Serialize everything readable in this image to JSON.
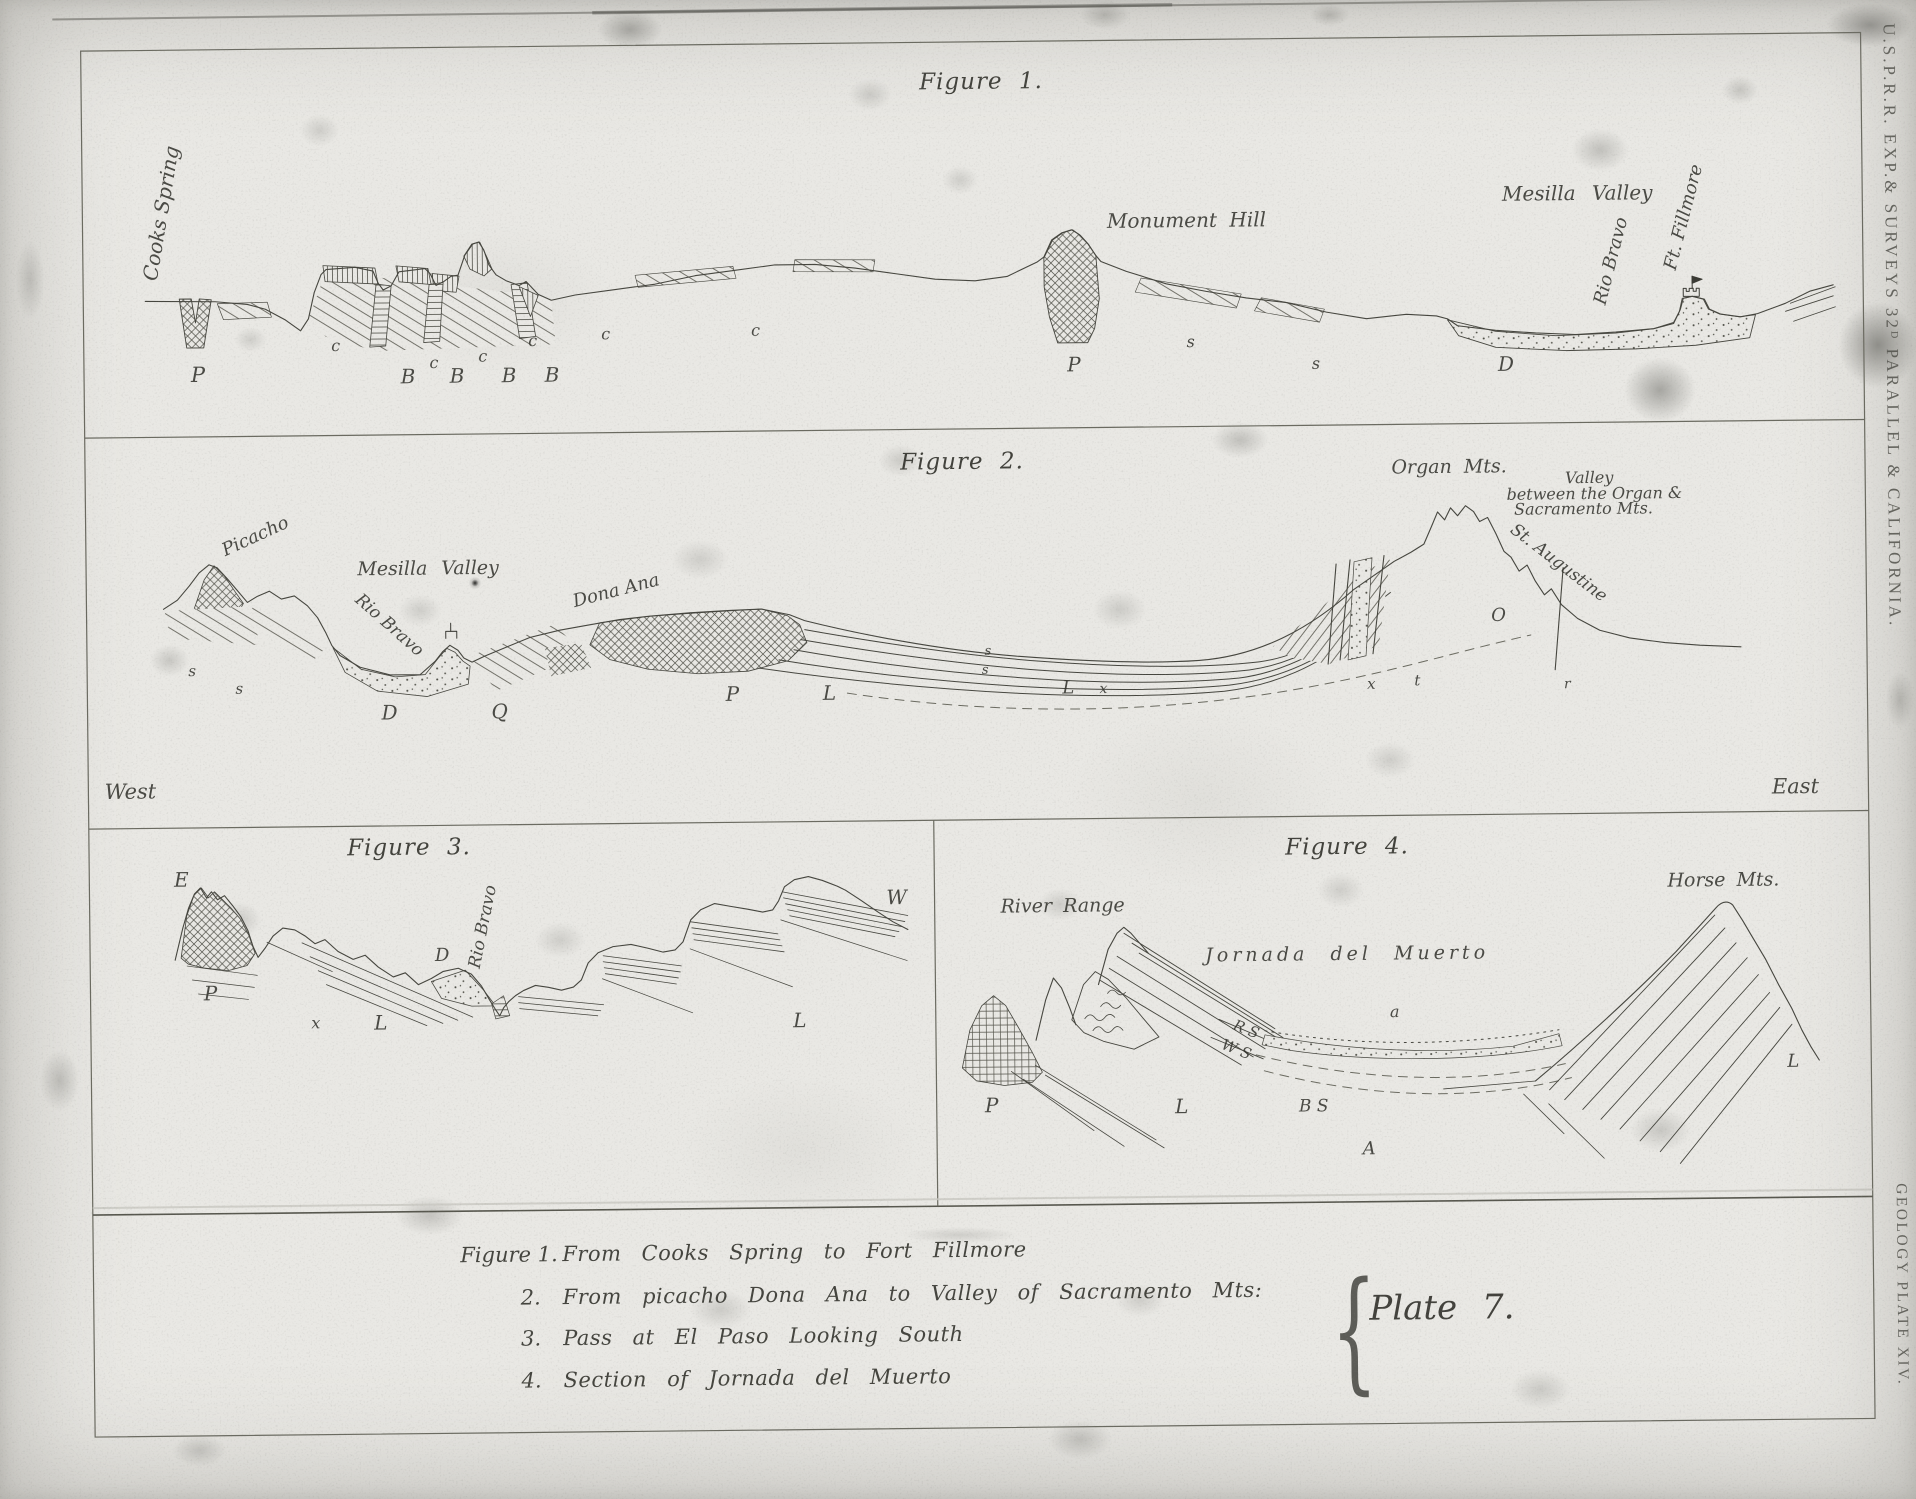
{
  "plate": {
    "margin_top": "U.S.P.R.R. EXP.& SURVEYS 32ᴰ PARALLEL & CALIFORNIA.",
    "margin_bottom": "GEOLOGY PLATE XIV.",
    "plate_label": "Plate 7.",
    "brace_glyph": "{",
    "west": "West",
    "east": "East"
  },
  "figures": [
    {
      "title": "Figure 1.",
      "labels": [
        {
          "t": "Cooks Spring",
          "n": "label-cooks-spring",
          "x": 167,
          "y": 205,
          "r": -80,
          "s": 20,
          "c": "pl"
        },
        {
          "t": "Monument Hill",
          "n": "label-monument-hill",
          "x": 1192,
          "y": 223,
          "s": 20,
          "w": 6,
          "c": "pl"
        },
        {
          "t": "Mesilla Valley",
          "n": "label-mesilla-valley-fig1",
          "x": 1583,
          "y": 200,
          "s": 20,
          "w": 10,
          "c": "pl"
        },
        {
          "t": "Rio Bravo",
          "n": "label-rio-bravo-fig1",
          "x": 1617,
          "y": 268,
          "r": -75,
          "s": 18,
          "c": "pl"
        },
        {
          "t": "Ft. Fillmore",
          "n": "label-ft-fillmore",
          "x": 1690,
          "y": 225,
          "r": -75,
          "s": 18,
          "c": "pl"
        },
        {
          "t": "P",
          "x": 202,
          "y": 367,
          "s": 21
        },
        {
          "t": "c",
          "x": 340,
          "y": 340,
          "s": 16
        },
        {
          "t": "B",
          "x": 412,
          "y": 371,
          "s": 20
        },
        {
          "t": "c",
          "x": 438,
          "y": 358,
          "s": 16
        },
        {
          "t": "B",
          "x": 461,
          "y": 371,
          "s": 20
        },
        {
          "t": "c",
          "x": 487,
          "y": 352,
          "s": 16
        },
        {
          "t": "B",
          "x": 513,
          "y": 371,
          "s": 20
        },
        {
          "t": "c",
          "x": 537,
          "y": 337,
          "s": 16
        },
        {
          "t": "B",
          "x": 556,
          "y": 371,
          "s": 20
        },
        {
          "t": "c",
          "x": 610,
          "y": 331,
          "s": 16
        },
        {
          "t": "c",
          "x": 760,
          "y": 329,
          "s": 16
        },
        {
          "t": "P",
          "x": 1078,
          "y": 366,
          "s": 20
        },
        {
          "t": "s",
          "x": 1195,
          "y": 345,
          "s": 16
        },
        {
          "t": "s",
          "x": 1320,
          "y": 368,
          "s": 16
        },
        {
          "t": "D",
          "x": 1510,
          "y": 370,
          "s": 20
        }
      ]
    },
    {
      "title": "Figure 2.",
      "labels": [
        {
          "t": "Picacho",
          "n": "label-picacho",
          "x": 258,
          "y": 530,
          "r": -24,
          "s": 18,
          "c": "pl"
        },
        {
          "t": "Mesilla Valley",
          "n": "label-mesilla-valley-fig2",
          "x": 430,
          "y": 564,
          "s": 19,
          "w": 8,
          "c": "pl"
        },
        {
          "t": "Rio Bravo",
          "n": "label-rio-bravo-fig2",
          "x": 390,
          "y": 620,
          "r": 42,
          "s": 17,
          "c": "pl"
        },
        {
          "t": "Dona Ana",
          "n": "label-dona-ana",
          "x": 618,
          "y": 588,
          "r": -14,
          "s": 18,
          "c": "pl"
        },
        {
          "t": "Organ Mts.",
          "n": "label-organ-mts",
          "x": 1452,
          "y": 473,
          "s": 19,
          "w": 6,
          "c": "pl"
        },
        {
          "t": "Valley",
          "n": "label-valley-line1",
          "x": 1592,
          "y": 485,
          "s": 16,
          "c": "pl"
        },
        {
          "t": "between the Organ &",
          "n": "label-valley-line2",
          "x": 1597,
          "y": 501,
          "s": 16,
          "c": "pl"
        },
        {
          "t": "Sacramento Mts.",
          "n": "label-valley-line3",
          "x": 1586,
          "y": 516,
          "s": 16,
          "c": "pl"
        },
        {
          "t": "St. Augustine",
          "n": "label-st-augustine",
          "x": 1560,
          "y": 570,
          "r": 38,
          "s": 17,
          "c": "pl"
        },
        {
          "t": "s",
          "x": 193,
          "y": 664,
          "s": 15
        },
        {
          "t": "s",
          "x": 240,
          "y": 682,
          "s": 15
        },
        {
          "t": "D",
          "x": 390,
          "y": 707,
          "s": 20
        },
        {
          "t": "Q",
          "x": 500,
          "y": 707,
          "s": 20
        },
        {
          "t": "P",
          "x": 733,
          "y": 692,
          "s": 20
        },
        {
          "t": "L",
          "x": 830,
          "y": 692,
          "s": 20
        },
        {
          "t": "s",
          "x": 989,
          "y": 652,
          "s": 13
        },
        {
          "t": "s",
          "x": 986,
          "y": 671,
          "s": 13
        },
        {
          "t": "L",
          "x": 1069,
          "y": 690,
          "s": 18
        },
        {
          "t": "x",
          "x": 1104,
          "y": 691,
          "s": 14
        },
        {
          "t": "x",
          "x": 1372,
          "y": 689,
          "s": 15
        },
        {
          "t": "t",
          "x": 1418,
          "y": 686,
          "s": 15
        },
        {
          "t": "O",
          "x": 1500,
          "y": 622,
          "s": 18
        },
        {
          "t": "r",
          "x": 1568,
          "y": 691,
          "s": 14
        }
      ]
    },
    {
      "title": "Figure 3.",
      "labels": [
        {
          "t": "Rio Bravo",
          "n": "label-rio-bravo-fig3",
          "x": 482,
          "y": 922,
          "r": -78,
          "s": 17,
          "c": "pl"
        },
        {
          "t": "E",
          "x": 180,
          "y": 872,
          "s": 20
        },
        {
          "t": "P",
          "x": 208,
          "y": 986,
          "s": 20
        },
        {
          "t": "x",
          "x": 313,
          "y": 1017,
          "s": 16
        },
        {
          "t": "L",
          "x": 378,
          "y": 1017,
          "s": 20
        },
        {
          "t": "D",
          "x": 440,
          "y": 951,
          "s": 18
        },
        {
          "t": "L",
          "x": 797,
          "y": 1019,
          "s": 20
        },
        {
          "t": "W",
          "x": 895,
          "y": 897,
          "s": 20
        }
      ]
    },
    {
      "title": "Figure 4.",
      "labels": [
        {
          "t": "River Range",
          "n": "label-river-range",
          "x": 1061,
          "y": 908,
          "s": 19,
          "w": 5,
          "c": "pl"
        },
        {
          "t": "Jornada del Muerto",
          "n": "label-jornada-del-muerto",
          "x": 1345,
          "y": 959,
          "s": 19,
          "k": 4,
          "w": 12,
          "c": "pl"
        },
        {
          "t": "Horse Mts.",
          "n": "label-horse-mts",
          "x": 1722,
          "y": 889,
          "s": 19,
          "w": 5,
          "c": "pl"
        },
        {
          "t": "a",
          "x": 1392,
          "y": 1017,
          "s": 16
        },
        {
          "t": "R S",
          "x": 1243,
          "y": 1033,
          "r": 22,
          "s": 15
        },
        {
          "t": "W S",
          "x": 1233,
          "y": 1053,
          "r": 22,
          "s": 15
        },
        {
          "t": "P",
          "x": 988,
          "y": 1106,
          "s": 20
        },
        {
          "t": "L",
          "x": 1178,
          "y": 1109,
          "s": 20
        },
        {
          "t": "B S",
          "x": 1310,
          "y": 1111,
          "s": 17
        },
        {
          "t": "A",
          "x": 1365,
          "y": 1154,
          "s": 18
        },
        {
          "t": "L",
          "x": 1790,
          "y": 1071,
          "s": 18
        }
      ]
    }
  ],
  "captions": {
    "items": [
      {
        "num": "Figure 1.",
        "text": "From Cooks Spring to Fort Fillmore"
      },
      {
        "num": "2.",
        "text": "From picacho Dona Ana to Valley of Sacramento Mts:"
      },
      {
        "num": "3.",
        "text": "Pass at El Paso Looking South"
      },
      {
        "num": "4.",
        "text": "Section of Jornada del Muerto"
      }
    ]
  }
}
